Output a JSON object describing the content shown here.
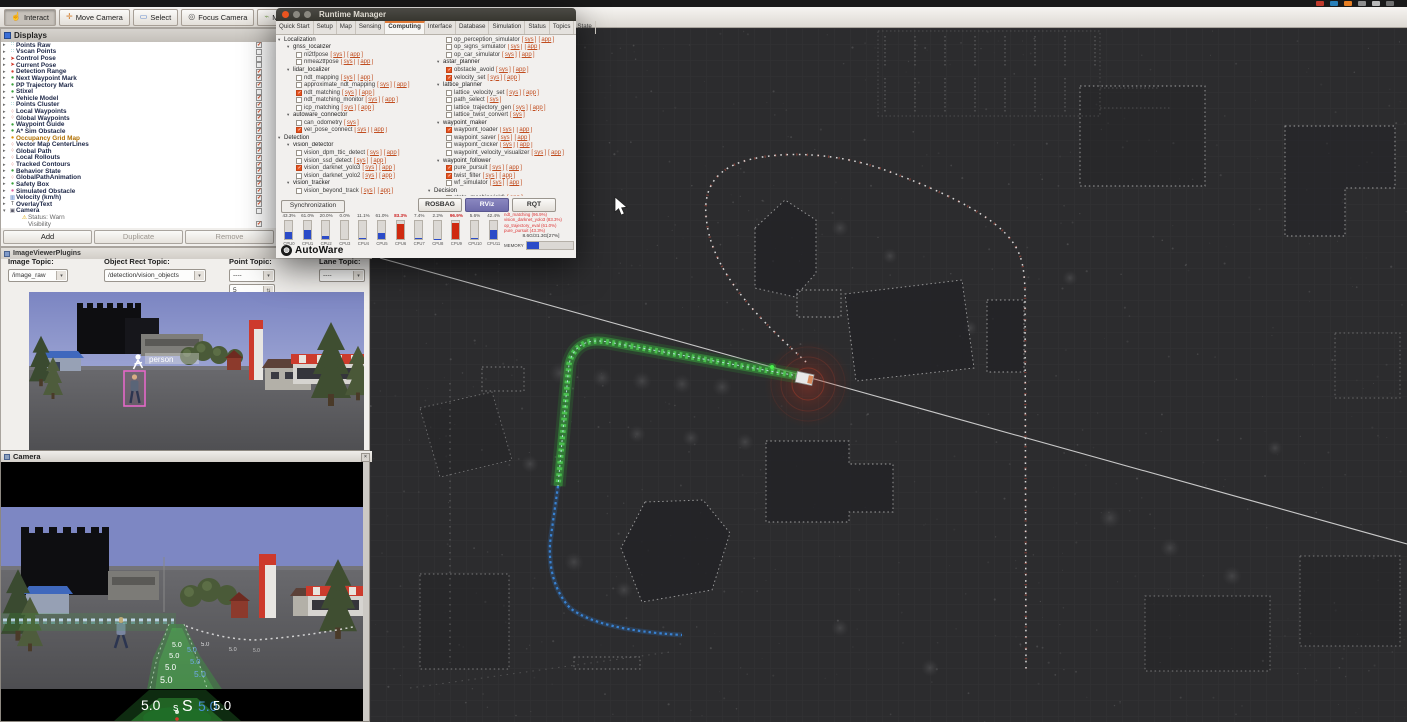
{
  "desktop": {
    "tray_colors": [
      "#c0392b",
      "#2980b9",
      "#e67e22",
      "#8e8e8e",
      "#b9b9b9",
      "#6f6f6f"
    ]
  },
  "toolbar": {
    "tools": [
      {
        "label": "Interact",
        "icon": "☝",
        "color": "#555",
        "active": true
      },
      {
        "label": "Move Camera",
        "icon": "✛",
        "color": "#d07a28",
        "active": false
      },
      {
        "label": "Select",
        "icon": "▭",
        "color": "#4a78c8",
        "active": false
      },
      {
        "label": "Focus Camera",
        "icon": "◎",
        "color": "#555",
        "active": false
      },
      {
        "label": "Measure",
        "icon": "⌁",
        "color": "#8a6",
        "active": false
      },
      {
        "label": "2D Pose Estimate",
        "icon": "➤",
        "color": "#2a9e2a",
        "active": false
      },
      {
        "label": "2D Nav Goal",
        "icon": "➤",
        "color": "#2a9e2a",
        "active": false
      }
    ]
  },
  "displays_panel": {
    "title": "Displays",
    "items": [
      {
        "label": "Points Raw",
        "checked": true,
        "icon": "∷",
        "color": "#2aa0a0"
      },
      {
        "label": "Vscan Points",
        "checked": false,
        "icon": "∷",
        "color": "#2aa0a0"
      },
      {
        "label": "Control Pose",
        "checked": false,
        "icon": "➤",
        "color": "#d03020"
      },
      {
        "label": "Current Pose",
        "checked": false,
        "icon": "➤",
        "color": "#d03020"
      },
      {
        "label": "Detection Range",
        "checked": true,
        "icon": "●",
        "color": "#d04030"
      },
      {
        "label": "Next Waypoint Mark",
        "checked": true,
        "icon": "●",
        "color": "#3aa03a"
      },
      {
        "label": "PP Trajectory Mark",
        "checked": true,
        "icon": "●",
        "color": "#3aa03a"
      },
      {
        "label": "Stixel",
        "checked": false,
        "icon": "●",
        "color": "#3aa03a"
      },
      {
        "label": "Vehicle Model",
        "checked": true,
        "icon": "⌖",
        "color": "#777"
      },
      {
        "label": "Points Cluster",
        "checked": true,
        "icon": "∷",
        "color": "#2aa0a0"
      },
      {
        "label": "Local Waypoints",
        "checked": true,
        "icon": "⁘",
        "color": "#d04030"
      },
      {
        "label": "Global Waypoints",
        "checked": true,
        "icon": "⁘",
        "color": "#d04030"
      },
      {
        "label": "Waypoint Guide",
        "checked": true,
        "icon": "●",
        "color": "#3aa03a"
      },
      {
        "label": "A* Sim Obstacle",
        "checked": true,
        "icon": "●",
        "color": "#3aa03a"
      },
      {
        "label": "Occupancy Grid Map",
        "checked": true,
        "icon": "●",
        "color": "#e09000",
        "label_color": "#b06f00"
      },
      {
        "label": "Vector Map CenterLines",
        "checked": true,
        "icon": "⁘",
        "color": "#d04030"
      },
      {
        "label": "Global Path",
        "checked": true,
        "icon": "⁘",
        "color": "#d04030"
      },
      {
        "label": "Local Rollouts",
        "checked": true,
        "icon": "⁘",
        "color": "#d04030"
      },
      {
        "label": "Tracked Contours",
        "checked": true,
        "icon": "⁘",
        "color": "#d04030"
      },
      {
        "label": "Behavior State",
        "checked": true,
        "icon": "●",
        "color": "#3aa03a"
      },
      {
        "label": "GlobalPathAnimation",
        "checked": true,
        "icon": "⁘",
        "color": "#d04030"
      },
      {
        "label": "Safety Box",
        "checked": true,
        "icon": "●",
        "color": "#3aa03a"
      },
      {
        "label": "Simulated Obstacle",
        "checked": true,
        "icon": "●",
        "color": "#e060a0"
      },
      {
        "label": "Velocity (km/h)",
        "checked": true,
        "icon": "▥",
        "color": "#3a6ac0"
      },
      {
        "label": "OverlayText",
        "checked": true,
        "icon": "T",
        "color": "#555"
      },
      {
        "label": "Camera",
        "checked": false,
        "icon": "▣",
        "color": "#556",
        "expanded": true
      },
      {
        "label": "Status: Warn",
        "child": true,
        "icon": "⚠",
        "color": "#d8a800"
      },
      {
        "label": "Visibility",
        "child": true,
        "checked": true,
        "icon": "",
        "color": "#888"
      }
    ],
    "buttons": [
      {
        "label": "Add",
        "dim": false
      },
      {
        "label": "Duplicate",
        "dim": true
      },
      {
        "label": "Remove",
        "dim": true
      }
    ]
  },
  "image_viewer": {
    "panel_title": "ImageViewerPlugins",
    "fields": [
      {
        "label": "Image Topic:",
        "value": "/image_raw"
      },
      {
        "label": "Object Rect Topic:",
        "value": "/detection/vision_objects"
      },
      {
        "label": "Point Topic:",
        "value": "----"
      },
      {
        "label": "Lane Topic:",
        "value": "----"
      }
    ],
    "spinner_value": "5",
    "detection_label": "person"
  },
  "camera_window": {
    "title": "Camera",
    "speed": "5.0",
    "marker_small": "s",
    "marker_big": "S"
  },
  "runtime_manager": {
    "title": "Runtime Manager",
    "tabs": [
      "Quick Start",
      "Setup",
      "Map",
      "Sensing",
      "Computing",
      "Interface",
      "Database",
      "Simulation",
      "Status",
      "Topics",
      "State"
    ],
    "active_tab": "Computing",
    "left_tree": [
      {
        "d": 0,
        "g": 1,
        "label": "Localization"
      },
      {
        "d": 1,
        "g": 1,
        "label": "gnss_localizer"
      },
      {
        "d": 2,
        "label": "nl2tfpose",
        "checked": false,
        "links": [
          "sys",
          "app"
        ]
      },
      {
        "d": 2,
        "label": "nmea2tfpose",
        "checked": false,
        "links": [
          "sys",
          "app"
        ]
      },
      {
        "d": 1,
        "g": 1,
        "label": "lidar_localizer"
      },
      {
        "d": 2,
        "label": "ndt_mapping",
        "checked": false,
        "links": [
          "sys",
          "app"
        ]
      },
      {
        "d": 2,
        "label": "approximate_ndt_mapping",
        "checked": false,
        "links": [
          "sys",
          "app"
        ]
      },
      {
        "d": 2,
        "label": "ndt_matching",
        "checked": true,
        "links": [
          "sys",
          "app"
        ]
      },
      {
        "d": 2,
        "label": "ndt_matching_monitor",
        "checked": false,
        "links": [
          "sys",
          "app"
        ]
      },
      {
        "d": 2,
        "label": "icp_matching",
        "checked": false,
        "links": [
          "sys",
          "app"
        ]
      },
      {
        "d": 1,
        "g": 1,
        "label": "autoware_connector"
      },
      {
        "d": 2,
        "label": "can_odometry",
        "checked": false,
        "links": [
          "sys"
        ]
      },
      {
        "d": 2,
        "label": "vel_pose_connect",
        "checked": true,
        "links": [
          "sys",
          "app"
        ]
      },
      {
        "d": 0,
        "g": 1,
        "label": "Detection"
      },
      {
        "d": 1,
        "g": 1,
        "label": "vision_detector"
      },
      {
        "d": 2,
        "label": "vision_dpm_ttic_detect",
        "checked": false,
        "links": [
          "sys",
          "app"
        ]
      },
      {
        "d": 2,
        "label": "vision_ssd_detect",
        "checked": false,
        "links": [
          "sys",
          "app"
        ]
      },
      {
        "d": 2,
        "label": "vision_darknet_yolo3",
        "checked": true,
        "links": [
          "sys",
          "app"
        ]
      },
      {
        "d": 2,
        "label": "vision_darknet_yolo2",
        "checked": false,
        "links": [
          "sys",
          "app"
        ]
      },
      {
        "d": 1,
        "g": 1,
        "label": "vision_tracker"
      },
      {
        "d": 2,
        "label": "vision_beyond_track",
        "checked": false,
        "links": [
          "sys",
          "app"
        ]
      }
    ],
    "right_tree": [
      {
        "d": 2,
        "label": "op_perception_simulator",
        "checked": false,
        "links": [
          "sys",
          "app"
        ]
      },
      {
        "d": 2,
        "label": "op_signs_simulator",
        "checked": false,
        "links": [
          "sys",
          "app"
        ]
      },
      {
        "d": 2,
        "label": "op_car_simulator",
        "checked": false,
        "links": [
          "sys",
          "app"
        ]
      },
      {
        "d": 1,
        "g": 1,
        "label": "astar_planner"
      },
      {
        "d": 2,
        "label": "obstacle_avoid",
        "checked": true,
        "links": [
          "sys",
          "app"
        ]
      },
      {
        "d": 2,
        "label": "velocity_set",
        "checked": true,
        "links": [
          "sys",
          "app"
        ]
      },
      {
        "d": 1,
        "g": 1,
        "label": "lattice_planner"
      },
      {
        "d": 2,
        "label": "lattice_velocity_set",
        "checked": false,
        "links": [
          "sys",
          "app"
        ]
      },
      {
        "d": 2,
        "label": "path_select",
        "checked": false,
        "links": [
          "sys"
        ]
      },
      {
        "d": 2,
        "label": "lattice_trajectory_gen",
        "checked": false,
        "links": [
          "sys",
          "app"
        ]
      },
      {
        "d": 2,
        "label": "lattice_twist_convert",
        "checked": false,
        "links": [
          "sys"
        ]
      },
      {
        "d": 1,
        "g": 1,
        "label": "waypoint_maker"
      },
      {
        "d": 2,
        "label": "waypoint_loader",
        "checked": true,
        "links": [
          "sys",
          "app"
        ]
      },
      {
        "d": 2,
        "label": "waypoint_saver",
        "checked": false,
        "links": [
          "sys",
          "app"
        ]
      },
      {
        "d": 2,
        "label": "waypoint_clicker",
        "checked": false,
        "links": [
          "sys",
          "app"
        ]
      },
      {
        "d": 2,
        "label": "waypoint_velocity_visualizer",
        "checked": false,
        "links": [
          "sys",
          "app"
        ]
      },
      {
        "d": 1,
        "g": 1,
        "label": "waypoint_follower"
      },
      {
        "d": 2,
        "label": "pure_pursuit",
        "checked": true,
        "links": [
          "sys",
          "app"
        ]
      },
      {
        "d": 2,
        "label": "twist_filter",
        "checked": true,
        "links": [
          "sys",
          "app"
        ]
      },
      {
        "d": 2,
        "label": "wf_simulator",
        "checked": false,
        "links": [
          "sys",
          "app"
        ]
      },
      {
        "d": 0,
        "g": 1,
        "label": "Decision"
      },
      {
        "d": 2,
        "label": "state_machine(old)",
        "checked": false,
        "links": [
          "app"
        ]
      }
    ],
    "sync_label": "Synchronization",
    "buttons": [
      {
        "label": "ROSBAG",
        "primary": false
      },
      {
        "label": "RViz",
        "primary": true
      },
      {
        "label": "RQT",
        "primary": false
      }
    ],
    "cpu": {
      "labels": [
        "CPU0",
        "CPU1",
        "CPU2",
        "CPU3",
        "CPU4",
        "CPU5",
        "CPU6",
        "CPU7",
        "CPU8",
        "CPU9",
        "CPU10",
        "CPU11"
      ],
      "percents": [
        "43.3%",
        "61.0%",
        "20.0%",
        "0.0%",
        "11.1%",
        "61.0%",
        "83.3%",
        "7.4%",
        "2.2%",
        "96.9%",
        "5.6%",
        "42.4%"
      ],
      "bars": [
        40,
        48,
        18,
        0,
        6,
        33,
        85,
        6,
        2,
        90,
        8,
        48
      ],
      "hot": [
        6,
        9
      ]
    },
    "proc_lines": [
      "ndt_matching (96.9%)",
      "vision_darknet_yolo3 (83.3%)",
      "op_trajectory_eval (61.0%)",
      "pure_pursuit (43.3%)"
    ],
    "memory": {
      "label": "MEMORY",
      "text": "8.6G/31.3G[27%]",
      "percent": 27
    },
    "logo_text": "AutoWare"
  }
}
